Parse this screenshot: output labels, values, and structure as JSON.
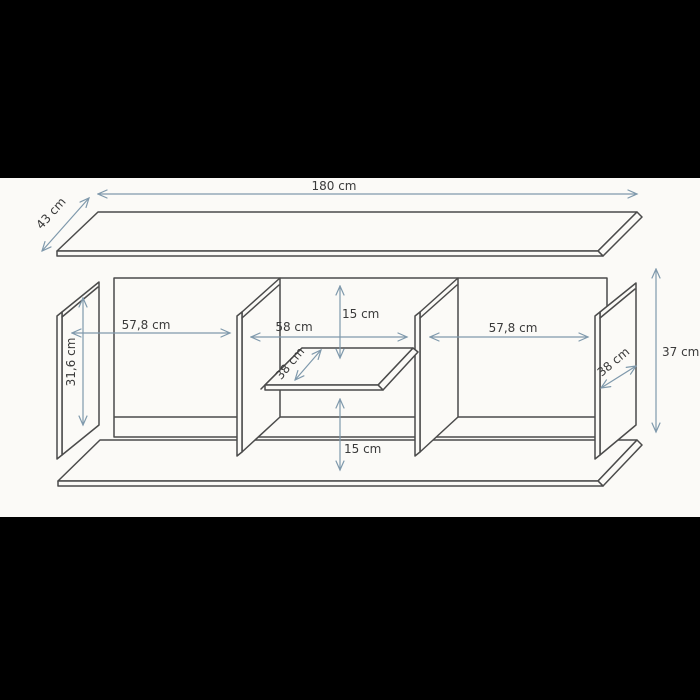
{
  "colors": {
    "letterbox": "#000000",
    "paper": "#fbfaf7",
    "outline": "#4b4b4b",
    "dimension_lines": "#7f99ac",
    "label_text": "#3a3a3a"
  },
  "diagram": {
    "type": "furniture-dimension-drawing",
    "parts": {
      "top_panel": "top panel (perspective)",
      "bottom_panel": "bottom panel (perspective)",
      "cabinet_frame": "cabinet front frame",
      "left_side_panel": "left side panel",
      "divider_left": "left center divider",
      "divider_right": "right center divider",
      "right_side_panel": "right side panel",
      "center_shelf": "center shelf (perspective)"
    }
  },
  "dims": {
    "top_panel_width": "180 cm",
    "top_panel_depth": "43 cm",
    "left_section_width": "57,8 cm",
    "center_section_width": "58 cm",
    "right_section_width": "57,8 cm",
    "side_panel_height": "31,6 cm",
    "shelf_depth": "38 cm",
    "side_panel_depth": "38 cm",
    "upper_clearance": "15 cm",
    "lower_clearance": "15 cm",
    "overall_height": "37 cm"
  }
}
